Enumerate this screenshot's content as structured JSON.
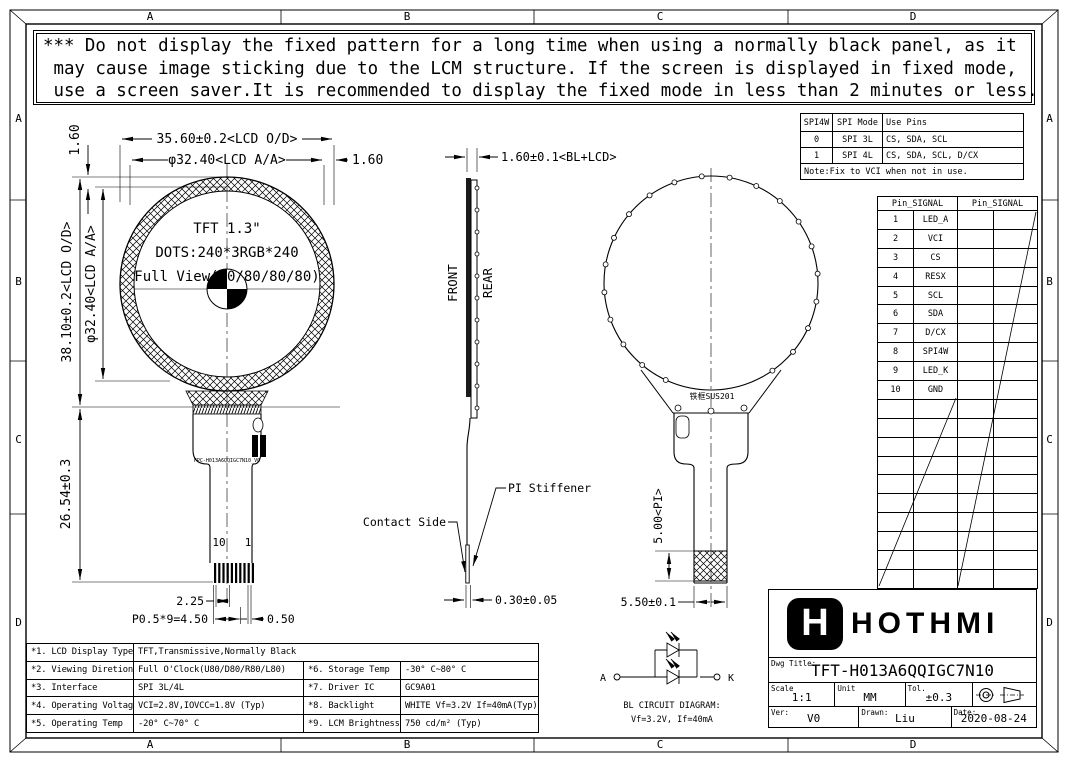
{
  "frame": {
    "cols": [
      "A",
      "B",
      "C",
      "D"
    ],
    "rows": [
      "A",
      "B",
      "C",
      "D"
    ]
  },
  "warning": {
    "lines": [
      "*** Do not display the fixed pattern for a long time when using a normally black panel, as it",
      " may cause image sticking due to the LCM structure. If the screen is displayed in fixed mode,",
      " use a screen saver.It is recommended to display the fixed mode in less than 2 minutes or less."
    ]
  },
  "front_view": {
    "panel_title": "TFT 1.3\"",
    "panel_dots": "DOTS:240*3RGB*240",
    "panel_view": "Full View(80/80/80/80)",
    "dim_width_od": "35.60±0.2<LCD O/D>",
    "dim_width_aa": "φ32.40<LCD A/A>",
    "dim_top_gap": "1.60",
    "dim_right_gap": "1.60",
    "dim_height_od": "38.10±0.2<LCD O/D>",
    "dim_height_aa": "φ32.40<LCD A/A>",
    "dim_fpc_length": "26.54±0.3",
    "pin_last": "10",
    "pin_first": "1",
    "dim_pin_offset": "2.25",
    "dim_pin_pitch": "P0.5*9=4.50",
    "dim_pin_width": "0.50",
    "fpc_marking": "FPC-H013A6QQIGC7N10_V0"
  },
  "side_view": {
    "label_front": "FRONT",
    "label_rear": "REAR",
    "dim_thickness": "1.60±0.1<BL+LCD>",
    "label_contact": "Contact Side",
    "label_stiffener": "PI Stiffener",
    "dim_fpc_thickness": "0.30±0.05"
  },
  "rear_view": {
    "label_frame": "铁框SUS201",
    "dim_stiffener_len": "5.00<PI>",
    "dim_tail_width": "5.50±0.1"
  },
  "spi_table": {
    "headers": [
      "SPI4W",
      "SPI Mode",
      "Use Pins"
    ],
    "rows": [
      [
        "0",
        "SPI 3L",
        "CS, SDA, SCL"
      ],
      [
        "1",
        "SPI 4L",
        "CS, SDA, SCL, D/CX"
      ]
    ],
    "note": "Note:Fix to VCI when not in use."
  },
  "pin_table": {
    "header": "Pin_SIGNAL",
    "rows": [
      [
        "1",
        "LED_A"
      ],
      [
        "2",
        "VCI"
      ],
      [
        "3",
        "CS"
      ],
      [
        "4",
        "RESX"
      ],
      [
        "5",
        "SCL"
      ],
      [
        "6",
        "SDA"
      ],
      [
        "7",
        "D/CX"
      ],
      [
        "8",
        "SPI4W"
      ],
      [
        "9",
        "LED_K"
      ],
      [
        "10",
        "GND"
      ]
    ]
  },
  "spec_table": {
    "rows": [
      {
        "k1": "*1. LCD Display Type",
        "v1": "TFT,Transmissive,Normally Black",
        "k2": "",
        "v2": ""
      },
      {
        "k1": "*2. Viewing Diretion",
        "v1": "Full O'Clock(U80/D80/R80/L80)",
        "k2": "*6. Storage Temp",
        "v2": "-30° C~80° C"
      },
      {
        "k1": "*3. Interface",
        "v1": "SPI 3L/4L",
        "k2": "*7. Driver IC",
        "v2": "GC9A01"
      },
      {
        "k1": "*4. Operating Voltage",
        "v1": "VCI=2.8V,IOVCC=1.8V (Typ)",
        "k2": "*8. Backlight",
        "v2": "WHITE Vf=3.2V If=40mA(Typ)"
      },
      {
        "k1": "*5. Operating Temp",
        "v1": "-20° C~70° C",
        "k2": "*9. LCM Brightness",
        "v2": "750 cd/m² (Typ)"
      }
    ]
  },
  "bl_circuit": {
    "anode": "A",
    "cathode": "K",
    "caption1": "BL CIRCUIT DIAGRAM:",
    "caption2": "Vf=3.2V, If=40mA"
  },
  "title_block": {
    "logo_letter": "H",
    "brand": "HOTHMI",
    "dwg_title_label": "Dwg Title:",
    "dwg_title": "TFT-H013A6QQIGC7N10",
    "scale_label": "Scale",
    "scale": "1:1",
    "unit_label": "Unit",
    "unit": "MM",
    "tol_label": "Tol.",
    "tol": "±0.3",
    "ver_label": "Ver:",
    "ver": "V0",
    "drawn_label": "Drawn:",
    "drawn": "Liu",
    "date_label": "Date:",
    "date": "2020-08-24"
  }
}
